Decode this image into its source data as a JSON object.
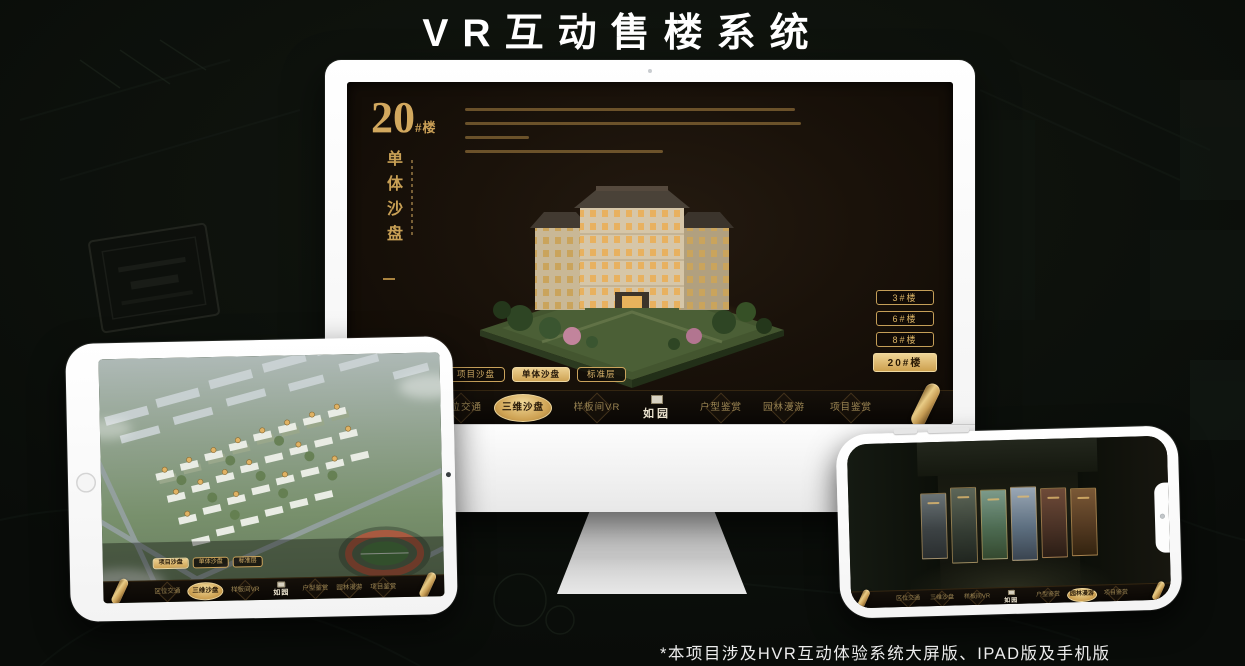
{
  "page": {
    "title": "VR互动售楼系统",
    "footnote": "*本项目涉及HVR互动体验系统大屏版、IPAD版及手机版"
  },
  "colors": {
    "gold": "#d4aa62",
    "gold_bright": "#ecd091",
    "gold_deep": "#b68c4a",
    "app_bg": "#17100a",
    "stage_bg": "#0a0d0a"
  },
  "sales_app": {
    "logo_text": "如园",
    "nav_items": [
      {
        "label": "区位交通"
      },
      {
        "label": "三维沙盘"
      },
      {
        "label": "样板间VR"
      },
      {
        "label": "户型鉴赏"
      },
      {
        "label": "园林漫游"
      },
      {
        "label": "项目鉴赏"
      }
    ],
    "tabs": [
      {
        "label": "项目沙盘"
      },
      {
        "label": "单体沙盘"
      },
      {
        "label": "标准层"
      }
    ],
    "monitor_view": {
      "headline_number": "20",
      "headline_suffix": "#楼",
      "headline_subtitle": "单体沙盘",
      "active_tab": "单体沙盘",
      "active_nav": "三维沙盘",
      "building_buttons": [
        {
          "label": "3#楼"
        },
        {
          "label": "6#楼"
        },
        {
          "label": "8#楼"
        },
        {
          "label": "20#楼",
          "selected": true
        }
      ]
    },
    "ipad_view": {
      "active_tab": "项目沙盘",
      "active_nav": "三维沙盘"
    },
    "phone_view": {
      "active_nav": "园林漫游"
    }
  }
}
